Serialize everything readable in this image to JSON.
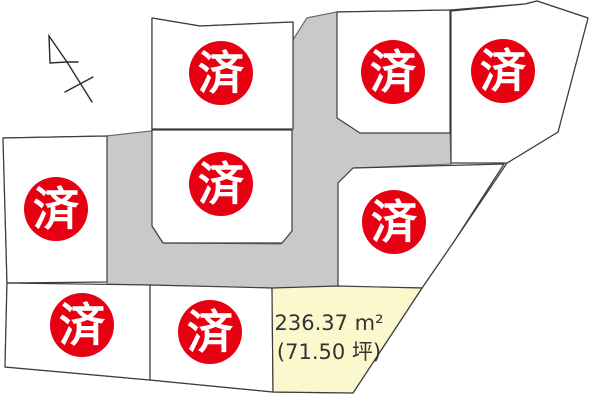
{
  "map": {
    "width": 600,
    "height": 404,
    "colors": {
      "background": "#ffffff",
      "lot_fill": "#ffffff",
      "lot_border": "#3d3d3d",
      "road_fill": "#c9c9cb",
      "road_border": "#6e6e6e",
      "sold_red": "#e60012",
      "badge_text": "#ffffff",
      "available_fill": "#fbf8cd",
      "label_text": "#333333",
      "north_arrow_stroke": "#2b2b2b"
    },
    "sold_badge": {
      "label": "済",
      "radius": 32,
      "font_size": 46
    },
    "boundary": [
      [
        3,
        138
      ],
      [
        107,
        136
      ],
      [
        152,
        131
      ],
      [
        152,
        18
      ],
      [
        200,
        26
      ],
      [
        293,
        22
      ],
      [
        293,
        40
      ],
      [
        307,
        18
      ],
      [
        337,
        12
      ],
      [
        450,
        10
      ],
      [
        525,
        4
      ],
      [
        537,
        1
      ],
      [
        588,
        18
      ],
      [
        558,
        132
      ],
      [
        507,
        163
      ],
      [
        455,
        240
      ],
      [
        422,
        288
      ],
      [
        353,
        393
      ],
      [
        273,
        392
      ],
      [
        150,
        380
      ],
      [
        5,
        367
      ],
      [
        7,
        283
      ]
    ],
    "road": [
      [
        293,
        40
      ],
      [
        307,
        18
      ],
      [
        337,
        12
      ],
      [
        337,
        118
      ],
      [
        360,
        133
      ],
      [
        450,
        133
      ],
      [
        451,
        164
      ],
      [
        353,
        168
      ],
      [
        338,
        183
      ],
      [
        338,
        287
      ],
      [
        272,
        288
      ],
      [
        150,
        285
      ],
      [
        107,
        284
      ],
      [
        107,
        136
      ],
      [
        152,
        131
      ],
      [
        152,
        226
      ],
      [
        163,
        243
      ],
      [
        281,
        244
      ],
      [
        292,
        231
      ],
      [
        292,
        129
      ]
    ],
    "lots": [
      {
        "id": "top-middle",
        "status": "sold",
        "points": [
          [
            152,
            18
          ],
          [
            200,
            26
          ],
          [
            293,
            22
          ],
          [
            293,
            129
          ],
          [
            152,
            129
          ]
        ],
        "badge": [
          221,
          73
        ]
      },
      {
        "id": "middle",
        "status": "sold",
        "points": [
          [
            152,
            130
          ],
          [
            292,
            130
          ],
          [
            292,
            231
          ],
          [
            282,
            243
          ],
          [
            163,
            243
          ],
          [
            152,
            226
          ]
        ],
        "badge": [
          221,
          184
        ]
      },
      {
        "id": "left",
        "status": "sold",
        "points": [
          [
            3,
            138
          ],
          [
            107,
            136
          ],
          [
            107,
            282
          ],
          [
            7,
            283
          ]
        ],
        "badge": [
          56,
          209
        ]
      },
      {
        "id": "top-right-1",
        "status": "sold",
        "points": [
          [
            337,
            12
          ],
          [
            450,
            10
          ],
          [
            450,
            133
          ],
          [
            360,
            133
          ],
          [
            337,
            118
          ]
        ],
        "badge": [
          393,
          72
        ]
      },
      {
        "id": "top-right-2",
        "status": "sold",
        "points": [
          [
            451,
            11
          ],
          [
            525,
            4
          ],
          [
            537,
            1
          ],
          [
            588,
            18
          ],
          [
            558,
            132
          ],
          [
            507,
            163
          ],
          [
            451,
            163
          ]
        ],
        "badge": [
          503,
          71
        ]
      },
      {
        "id": "middle-right",
        "status": "sold",
        "points": [
          [
            353,
            168
          ],
          [
            504,
            164
          ],
          [
            455,
            240
          ],
          [
            422,
            288
          ],
          [
            338,
            287
          ],
          [
            338,
            183
          ]
        ],
        "badge": [
          394,
          222
        ]
      },
      {
        "id": "bottom-left",
        "status": "sold",
        "points": [
          [
            7,
            283
          ],
          [
            150,
            285
          ],
          [
            150,
            380
          ],
          [
            5,
            367
          ]
        ],
        "badge": [
          82,
          325
        ]
      },
      {
        "id": "bottom-middle",
        "status": "sold",
        "points": [
          [
            150,
            285
          ],
          [
            272,
            288
          ],
          [
            273,
            392
          ],
          [
            150,
            380
          ]
        ],
        "badge": [
          210,
          332
        ]
      },
      {
        "id": "available",
        "status": "available",
        "points": [
          [
            272,
            288
          ],
          [
            338,
            286
          ],
          [
            422,
            288
          ],
          [
            353,
            393
          ],
          [
            273,
            392
          ]
        ],
        "labels": [
          {
            "text": "236.37 m²",
            "x": 329,
            "y": 330
          },
          {
            "text": "(71.50 坪)",
            "x": 329,
            "y": 359
          }
        ],
        "label_font_size": 21
      }
    ],
    "north_arrow": {
      "head": [
        [
          49,
          36
        ],
        [
          50,
          63
        ],
        [
          67,
          62
        ]
      ],
      "lines": [
        [
          [
            67,
            62
          ],
          [
            78,
            62
          ]
        ],
        [
          [
            67,
            62
          ],
          [
            92,
            102
          ]
        ],
        [
          [
            65,
            92
          ],
          [
            93,
            77
          ]
        ]
      ]
    }
  }
}
